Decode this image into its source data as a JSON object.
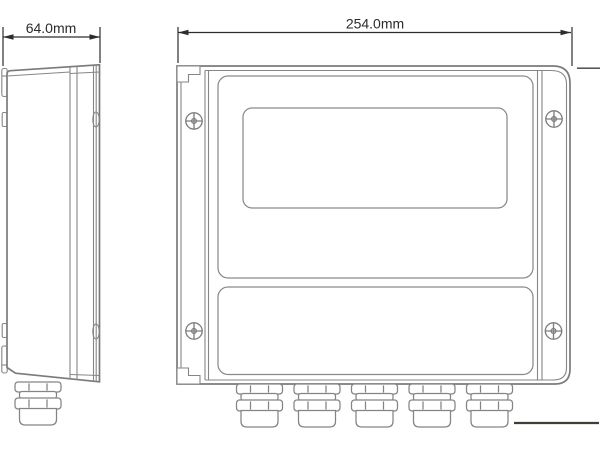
{
  "app": {
    "background_color": "#ffffff"
  },
  "drawing": {
    "units": "mm",
    "line_color": "#868686",
    "dimension_color": "#2d2d2d",
    "views": {
      "side": {
        "dimension_label": "64.0mm",
        "width_mm": 64.0,
        "cable_gland_count": 1,
        "mounting_tab_count": 2
      },
      "front": {
        "dimension_label": "254.0mm",
        "width_mm": 254.0,
        "screw_count": 4,
        "cable_gland_count": 5,
        "mounting_ear_count": 2
      }
    }
  }
}
